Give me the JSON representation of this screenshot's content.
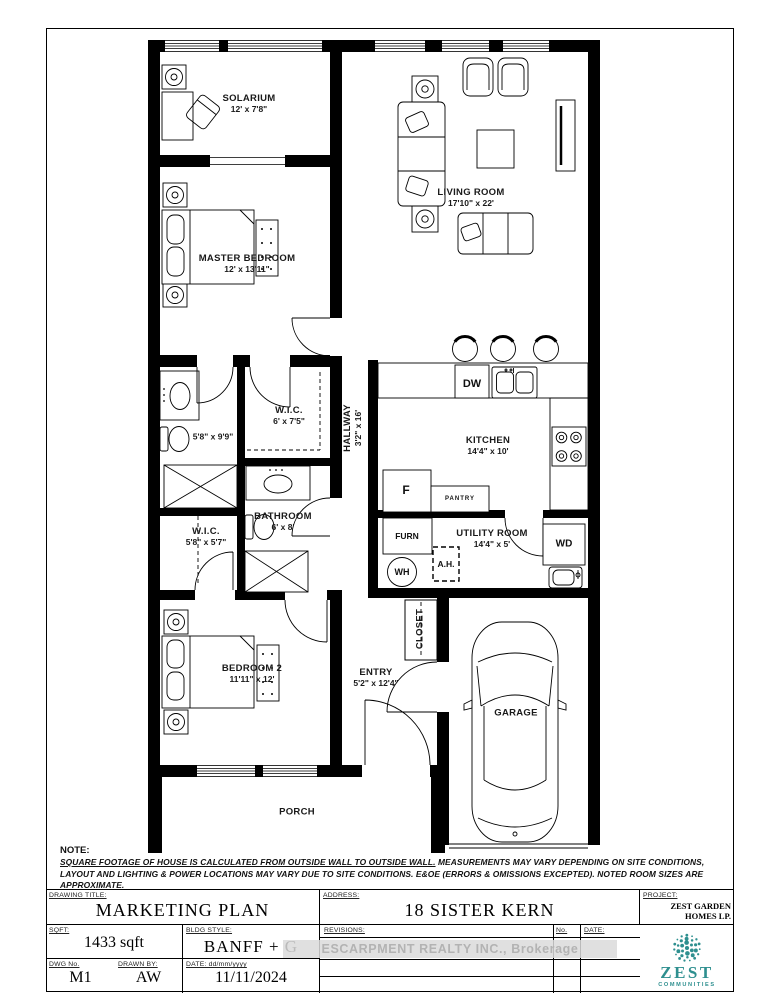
{
  "plan": {
    "rooms": {
      "solarium": {
        "name": "SOLARIUM",
        "dims": "12' x 7'8\""
      },
      "living_room": {
        "name": "LIVING ROOM",
        "dims": "17'10\" x 22'"
      },
      "master_bedroom": {
        "name": "MASTER BEDROOM",
        "dims": "12' x 13'11\""
      },
      "wic_master": {
        "name": "W.I.C.",
        "dims": "6' x 7'5\""
      },
      "hallway": {
        "name": "HALLWAY",
        "dims": "3'2\" x 16'"
      },
      "ensuite": {
        "name": "",
        "dims": "5'8\" x 9'9\""
      },
      "kitchen": {
        "name": "KITCHEN",
        "dims": "14'4\" x 10'"
      },
      "bathroom": {
        "name": "BATHROOM",
        "dims": "6' x 8'"
      },
      "wic_bedroom2": {
        "name": "W.I.C.",
        "dims": "5'8\" x 5'7\""
      },
      "utility_room": {
        "name": "UTILITY ROOM",
        "dims": "14'4\" x 5'"
      },
      "bedroom2": {
        "name": "BEDROOM 2",
        "dims": "11'11\" x 12'"
      },
      "entry": {
        "name": "ENTRY",
        "dims": "5'2\" x 12'4\""
      },
      "closet": {
        "name": "CLOSET",
        "dims": ""
      },
      "garage": {
        "name": "GARAGE",
        "dims": ""
      },
      "porch": {
        "name": "PORCH",
        "dims": ""
      }
    },
    "fixtures": {
      "dishwasher": "DW",
      "fridge": "F",
      "pantry": "PANTRY",
      "furnace": "FURN",
      "water_heater": "WH",
      "air_handler": "A.H.",
      "washer_dryer": "WD"
    }
  },
  "note": {
    "label": "NOTE:",
    "underlined": "SQUARE FOOTAGE OF HOUSE IS CALCULATED FROM OUTSIDE WALL TO OUTSIDE WALL.",
    "rest": " MEASUREMENTS MAY VARY DEPENDING ON SITE CONDITIONS, LAYOUT AND LIGHTING & POWER LOCATIONS MAY VARY DUE TO SITE CONDITIONS. E&OE (ERRORS & OMISSIONS EXCEPTED). NOTED ROOM SIZES ARE APPROXIMATE."
  },
  "title_block": {
    "drawing_title_label": "DRAWING TITLE:",
    "drawing_title": "MARKETING PLAN",
    "address_label": "ADDRESS:",
    "address": "18 SISTER KERN",
    "project_label": "PROJECT:",
    "project": "ZEST GARDEN HOMES LP.",
    "sqft_label": "SQFT:",
    "sqft": "1433 sqft",
    "bldg_style_label": "BLDG STYLE:",
    "bldg_style": "BANFF + G",
    "revisions_label": "REVISIONS:",
    "no_label": "No.",
    "date_col_label": "DATE:",
    "dwg_no_label": "DWG No.",
    "dwg_no": "M1",
    "drawn_by_label": "DRAWN BY:",
    "drawn_by": "AW",
    "date_label": "DATE: dd/mm/yyyy",
    "date": "11/11/2024"
  },
  "watermark": "ESCARPMENT REALTY INC., Brokerage",
  "logo": {
    "name": "ZEST",
    "sub": "COMMUNITIES",
    "color": "#2e8f8f"
  }
}
